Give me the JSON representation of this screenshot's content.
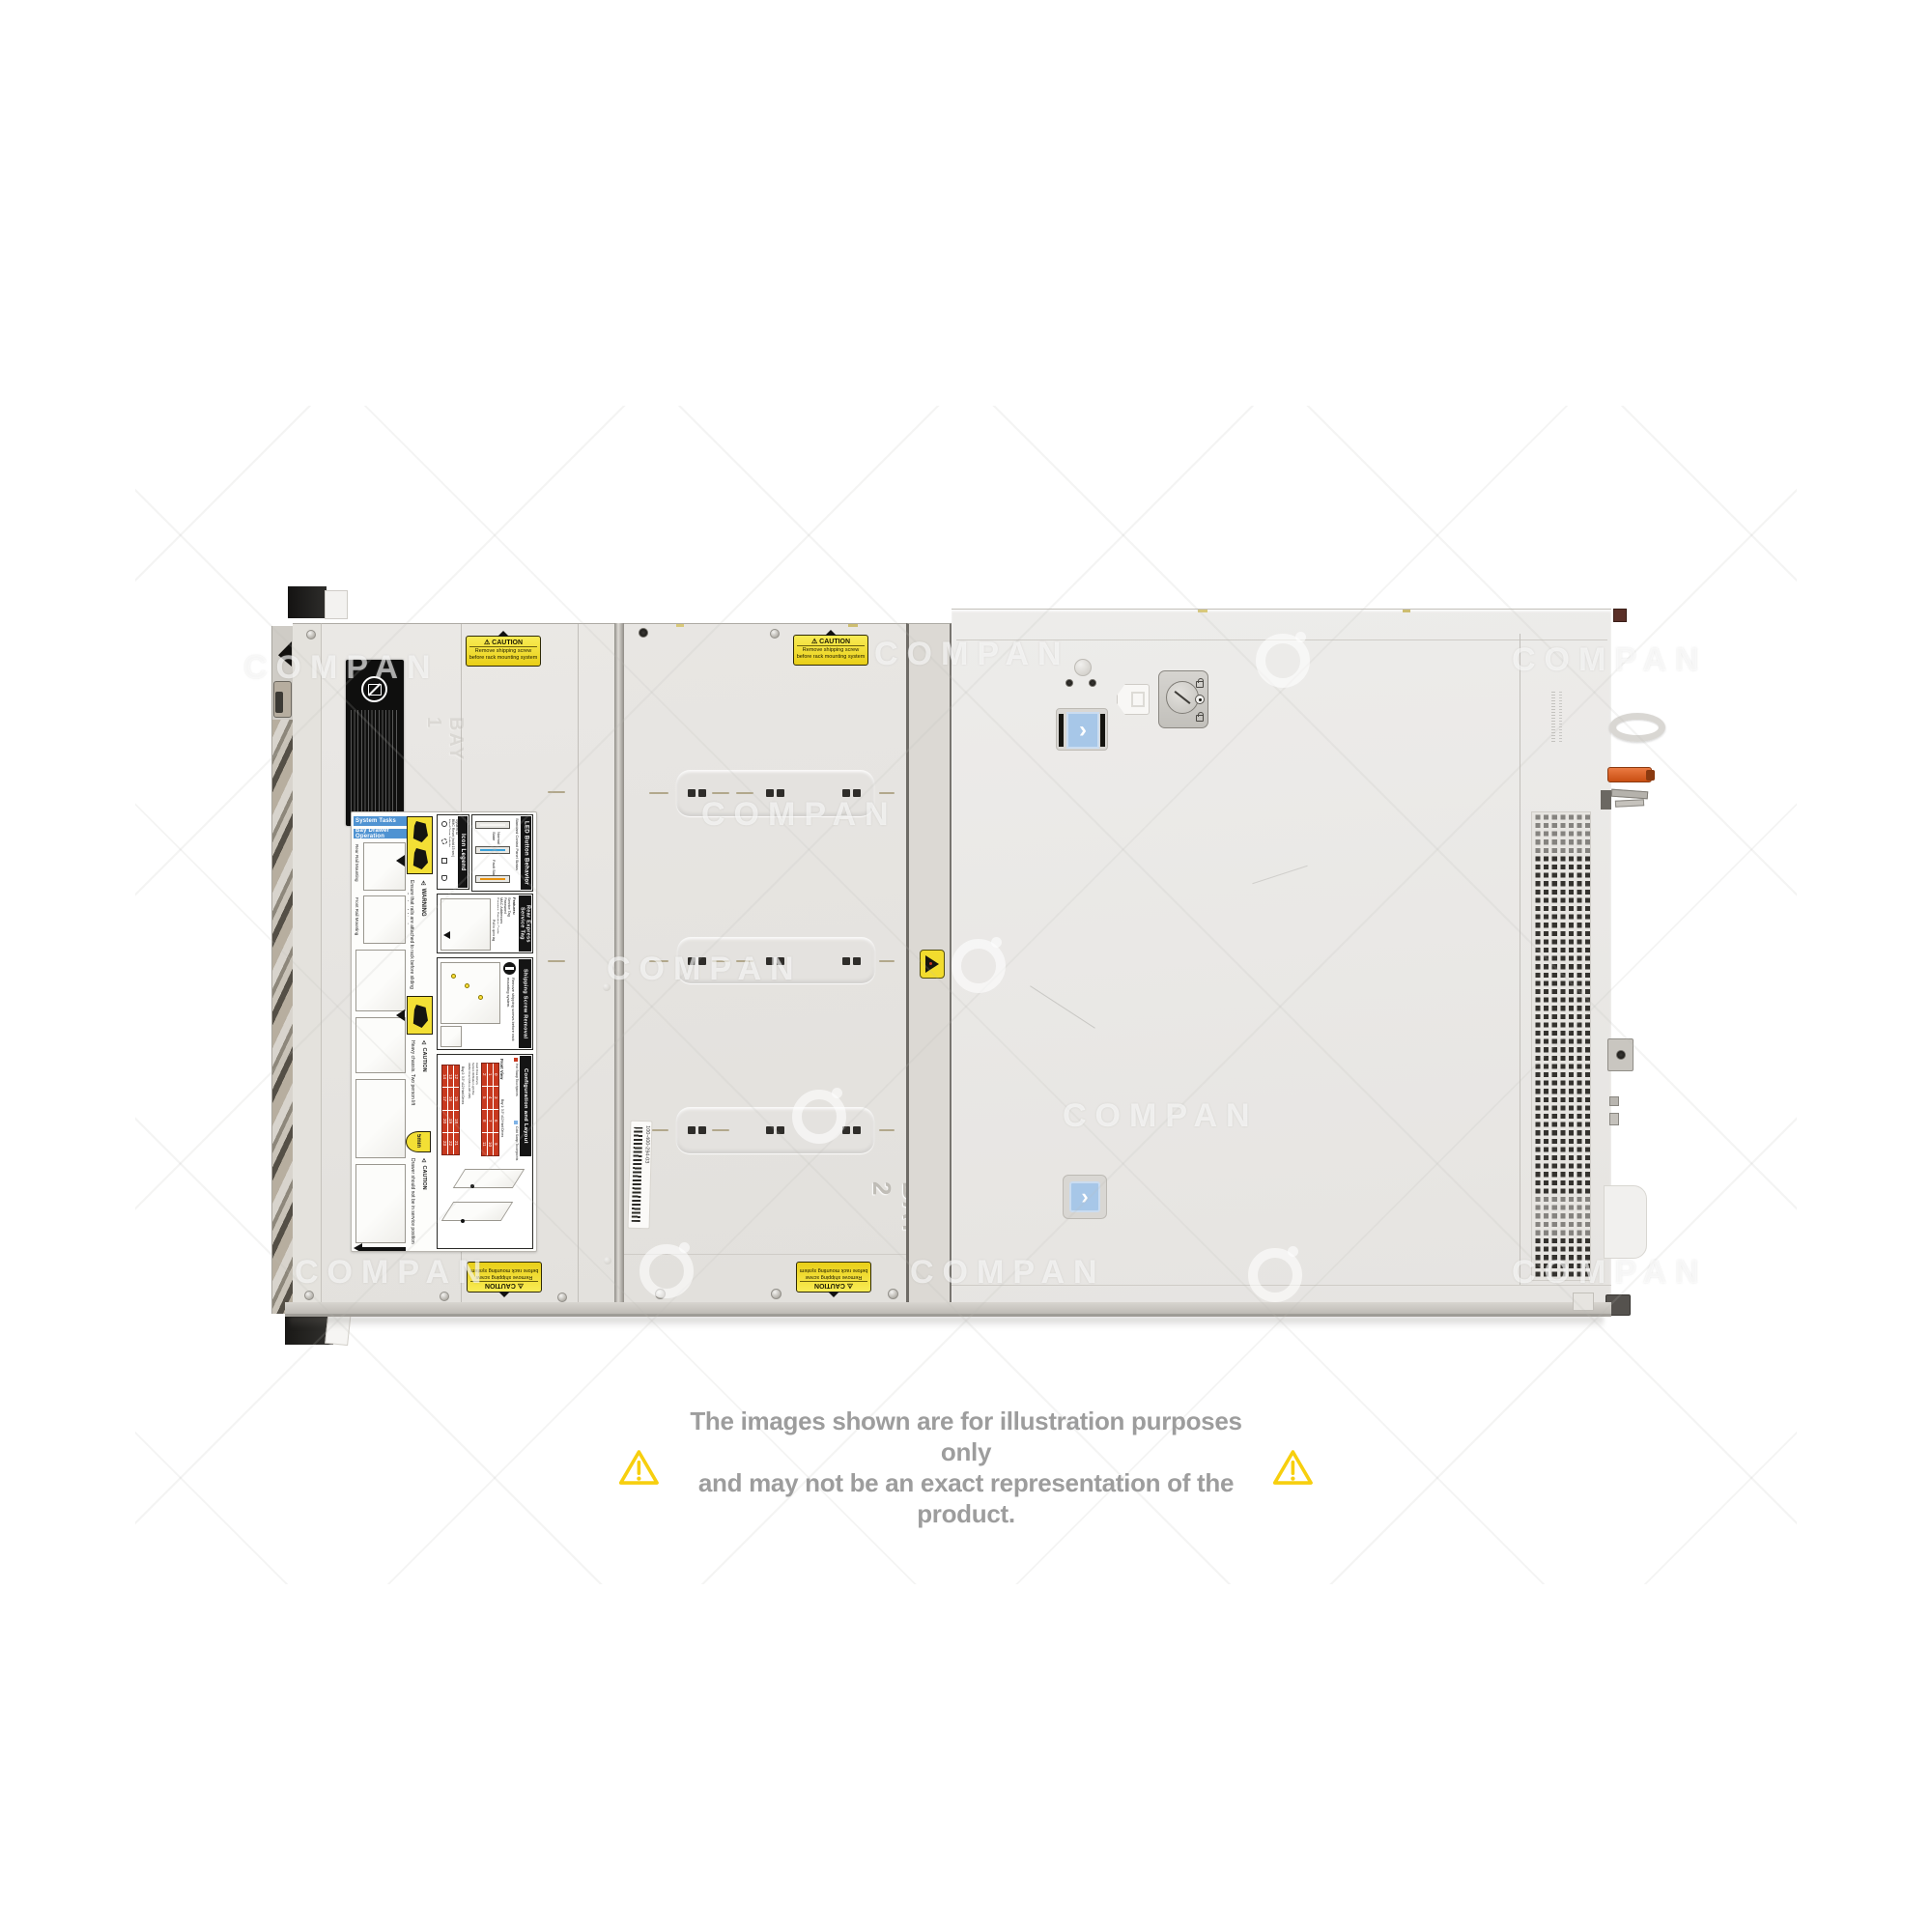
{
  "colors": {
    "caution_yellow": "#f2dc2e",
    "header_blue": "#4f93d2",
    "led_normal_blue": "#3aa0d8",
    "led_fault_orange": "#e8920f",
    "grid_red": "#c8391f",
    "blue_button": "#a7c7e8",
    "latch_orange": "#dd5f1e",
    "disclaimer_triangle": "#f7cf0e",
    "disclaimer_text": "#9d9d9d"
  },
  "watermark": {
    "text": "COMPAN"
  },
  "disclaimer": {
    "line1": "The images shown are for illustration purposes only",
    "line2": "and may not be an exact representation of the product."
  },
  "server": {
    "caution_label": {
      "title": "⚠ CAUTION",
      "line1": "Remove shipping screw",
      "line2": "before rack mounting system"
    },
    "barcode_label": "100-400-294-03",
    "bay2_embossed": "BAY 2",
    "bay1_embossed": "BAY 1",
    "instruction_label": {
      "system_tasks": "System Tasks",
      "bay_drawer_operation": "Bay Drawer Operation",
      "rear_rail": "Rear Rail Mounting",
      "front_rail": "Front Rail Mounting",
      "warning_title": "⚠ WARNING",
      "warning_text": "Ensure that rails are attached to rack before sliding open the hard drive bay.",
      "icon_legend_title": "Icon Legend",
      "icon_legend_items": [
        "System ID",
        "BMC Reset (hold 15 sec)",
        "Hard Drive Activity",
        "USB 2.0"
      ],
      "led_title": "LED Button Behavior",
      "led_subtitle": "Standard Control Panel Status",
      "led_normal": "Normal State",
      "led_fault": "Fault State",
      "service_title": "Rear Express Service Tag",
      "service_features_heading": "Features:",
      "service_features": [
        "Service Tag",
        "Password",
        "MAC Addresses",
        "Express Service Code"
      ],
      "service_note": "Pull to open tag",
      "shipping_title": "Shipping Screw Removal",
      "shipping_text": "Remove shipping screws before rack mounting system.",
      "caution_heavy_title": "⚠ CAUTION",
      "caution_heavy_text": "Heavy chassis. Two person lift required.",
      "five_min": "5min",
      "caution_drawer_title": "⚠ CAUTION",
      "caution_drawer_text": "Drawer should not be in service position for longer than five minutes.",
      "config_title": "Configuration and Layout",
      "config_hot": "Hot Swap Touchpoints",
      "config_cold": "Cold Swap Touchpoints",
      "front_view": "Front View",
      "bay1_label": "Bay 1: 3.5\" x12 Hard Drives",
      "bay2_label": "Bay 2: 3.5\" x12 Hard Drives",
      "bay1_numbers": [
        2,
        1,
        0,
        5,
        4,
        3,
        8,
        7,
        6,
        11,
        10,
        9
      ],
      "bay2_numbers": [
        14,
        13,
        12,
        17,
        16,
        15,
        20,
        19,
        18,
        23,
        22,
        21
      ],
      "config_sublabels": [
        "Hard Drive Activity",
        "System ID/Status Light Bar",
        "iDRAC Direct (Micro-AB USB)",
        "USB",
        "Power"
      ]
    }
  }
}
